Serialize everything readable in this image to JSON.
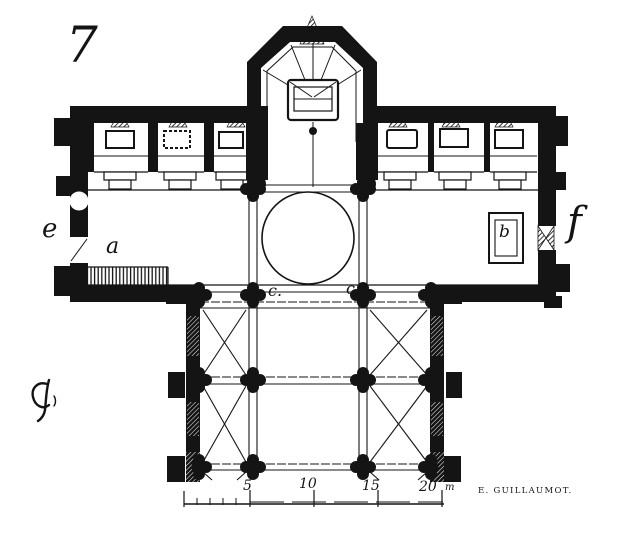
{
  "figure": {
    "number": "7"
  },
  "labels": {
    "west_feature": "e",
    "stairs": "a",
    "monument": "b",
    "pier_left": "c.",
    "pier_right": "c",
    "east_door": "f"
  },
  "scale_bar": {
    "ticks": [
      "5",
      "10",
      "15",
      "20"
    ],
    "unit": "m"
  },
  "credit": {
    "engraver": "E. GUILLAUMOT."
  },
  "icons": {
    "monogram": "engraver-monogram"
  },
  "colors": {
    "ink": "#141414",
    "paper": "#ffffff"
  }
}
